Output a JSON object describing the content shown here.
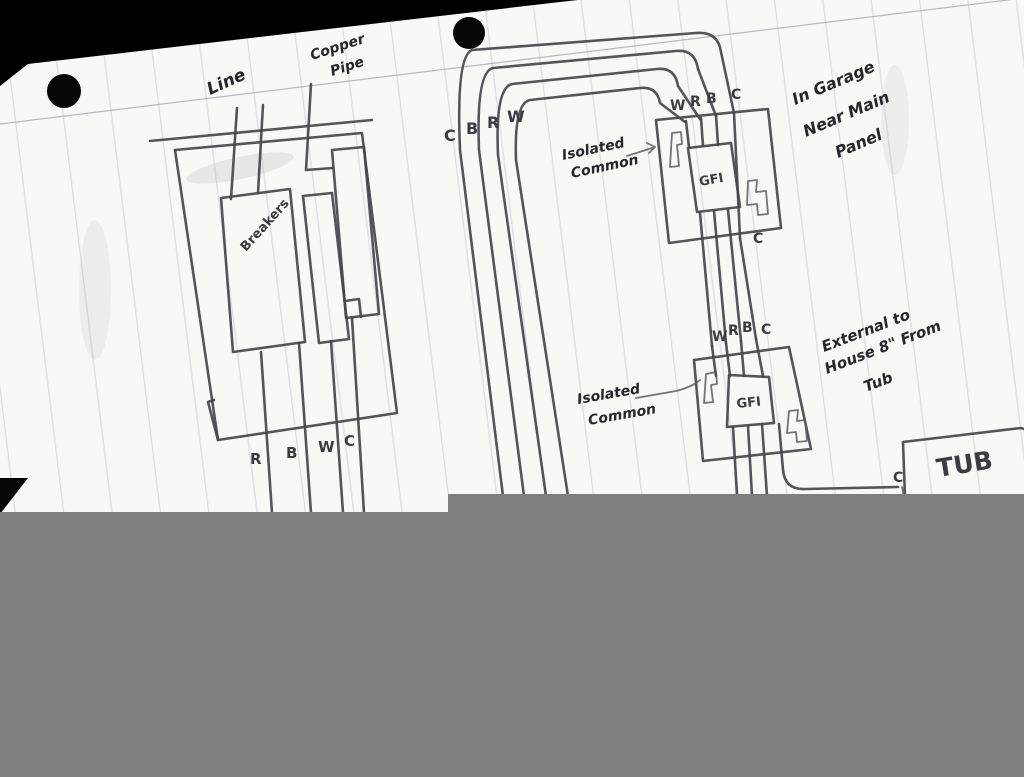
{
  "colors": {
    "background": "#000000",
    "paper": "#f8f8f6",
    "pencil": "#47474b",
    "ink": "#26262b",
    "ruled_line": "#c6cbd5",
    "censor": "#7e7e7e"
  },
  "panel": {
    "line_label": "Line",
    "copper_pipe_line1": "Copper",
    "copper_pipe_line2": "Pipe",
    "breakers_label": "Breakers",
    "bottom_wires": [
      "R",
      "B",
      "W",
      "C"
    ]
  },
  "riser": {
    "wires": [
      "C",
      "B",
      "R",
      "W"
    ]
  },
  "gfi_garage": {
    "label": "GFI",
    "top_wires": [
      "W",
      "R",
      "B",
      "C"
    ],
    "bottom_common": "C",
    "isolated_line1": "Isolated",
    "isolated_line2": "Common",
    "note_line1": "In Garage",
    "note_line2": "Near Main",
    "note_line3": "Panel"
  },
  "gfi_external": {
    "label": "GFI",
    "top_wires": [
      "W",
      "R",
      "B",
      "C"
    ],
    "isolated_line1": "Isolated",
    "isolated_line2": "Common",
    "note_line1": "External to",
    "note_line2": "House 8\" From",
    "note_line3": "Tub"
  },
  "tub": {
    "label": "TUB",
    "common": "C"
  }
}
